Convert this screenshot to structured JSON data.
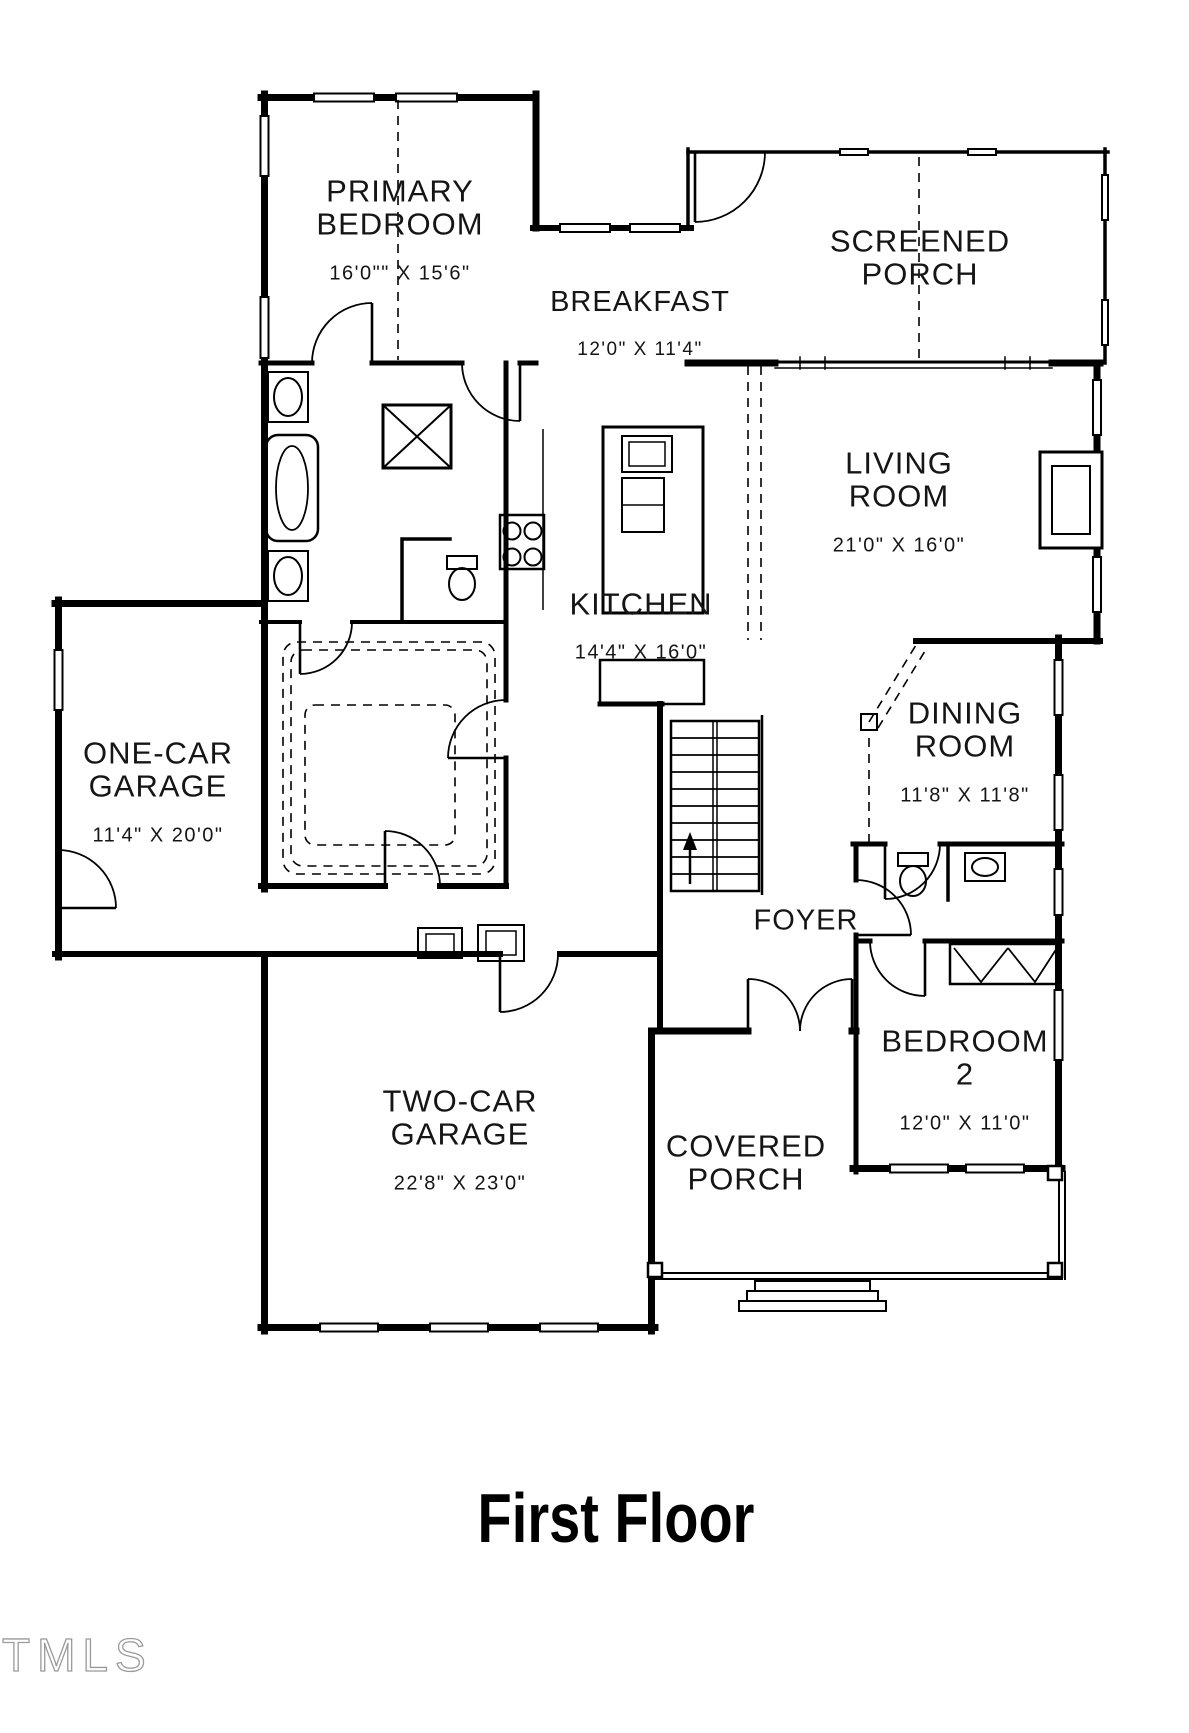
{
  "title": "First Floor",
  "watermark": "TMLS",
  "colors": {
    "line": "#000000",
    "text": "#151515",
    "watermark_stroke": "#9a9a9a",
    "background": "#ffffff"
  },
  "rooms": [
    {
      "id": "primary-bedroom",
      "name": "PRIMARY\nBEDROOM",
      "dims": "16'0\"\" X 15'6\""
    },
    {
      "id": "screened-porch",
      "name": "SCREENED\nPORCH",
      "dims": ""
    },
    {
      "id": "breakfast",
      "name": "BREAKFAST",
      "dims": "12'0\" X 11'4\""
    },
    {
      "id": "living-room",
      "name": "LIVING\nROOM",
      "dims": "21'0\" X 16'0\""
    },
    {
      "id": "kitchen",
      "name": "KITCHEN",
      "dims": "14'4\" X 16'0\""
    },
    {
      "id": "one-car-garage",
      "name": "ONE-CAR\nGARAGE",
      "dims": "11'4\" X 20'0\""
    },
    {
      "id": "dining-room",
      "name": "DINING\nROOM",
      "dims": "11'8\" X 11'8\""
    },
    {
      "id": "foyer",
      "name": "FOYER",
      "dims": ""
    },
    {
      "id": "two-car-garage",
      "name": "TWO-CAR\nGARAGE",
      "dims": "22'8\" X 23'0\""
    },
    {
      "id": "covered-porch",
      "name": "COVERED\nPORCH",
      "dims": ""
    },
    {
      "id": "bedroom-2",
      "name": "BEDROOM\n2",
      "dims": "12'0\" X 11'0\""
    }
  ]
}
